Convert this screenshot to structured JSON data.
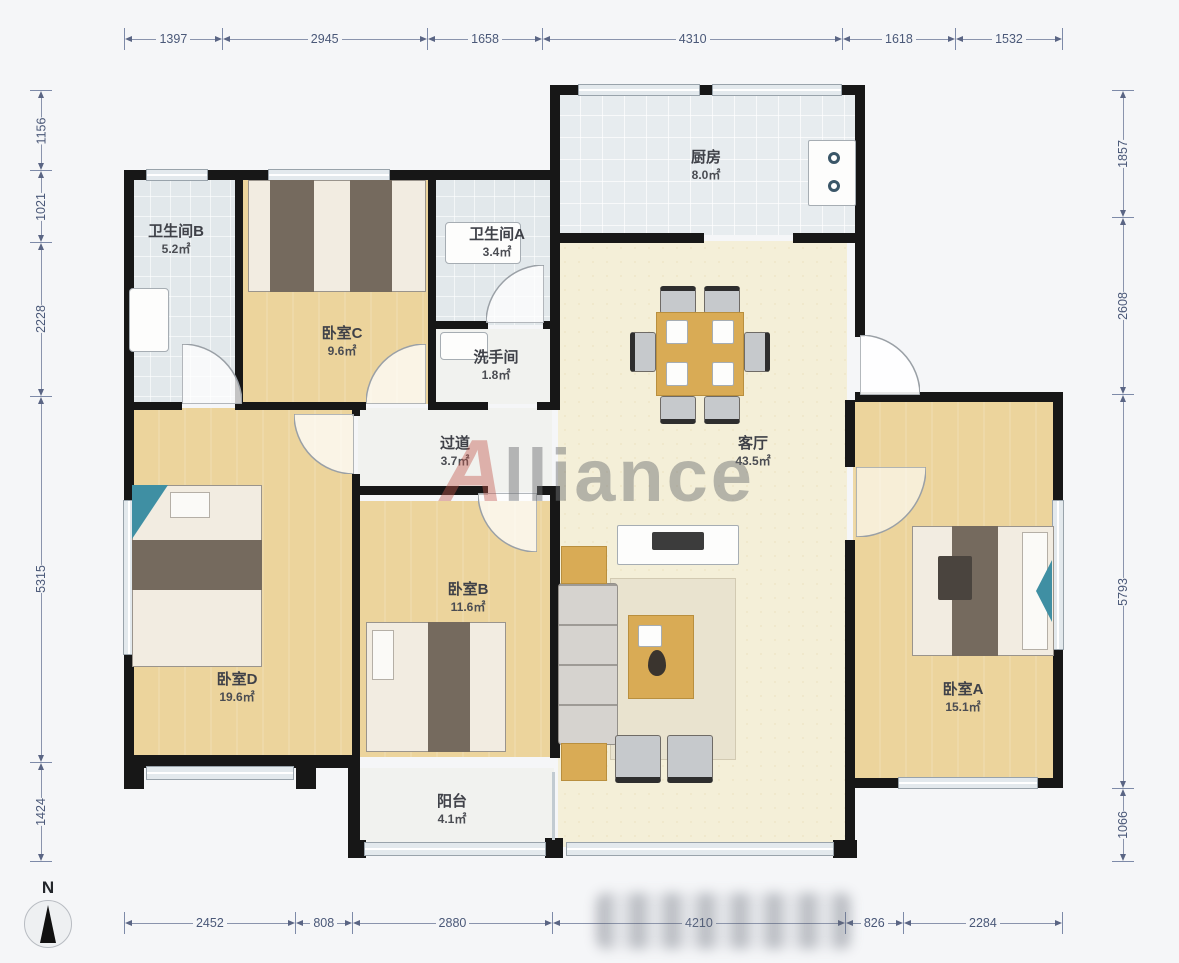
{
  "watermark": {
    "initial": "A",
    "rest": "lliance"
  },
  "north": {
    "label": "N"
  },
  "dimensions": {
    "top": [
      "1397",
      "2945",
      "1658",
      "4310",
      "1618",
      "1532"
    ],
    "bottom": [
      "2452",
      "808",
      "2880",
      "4210",
      "826",
      "2284"
    ],
    "left": [
      "1156",
      "1021",
      "2228",
      "5315",
      "1424"
    ],
    "right": [
      "1857",
      "2608",
      "5793",
      "1066"
    ]
  },
  "rooms": [
    {
      "name": "卫生间B",
      "area": "5.2㎡"
    },
    {
      "name": "卧室C",
      "area": "9.6㎡"
    },
    {
      "name": "卫生间A",
      "area": "3.4㎡"
    },
    {
      "name": "洗手间",
      "area": "1.8㎡"
    },
    {
      "name": "厨房",
      "area": "8.0㎡"
    },
    {
      "name": "过道",
      "area": "3.7㎡"
    },
    {
      "name": "客厅",
      "area": "43.5㎡"
    },
    {
      "name": "卧室B",
      "area": "11.6㎡"
    },
    {
      "name": "卧室D",
      "area": "19.6㎡"
    },
    {
      "name": "卧室A",
      "area": "15.1㎡"
    },
    {
      "name": "阳台",
      "area": "4.1㎡"
    }
  ],
  "colors": {
    "wall": "#171717",
    "wood_floor": "#ecd49c",
    "living_floor": "#f4efd8",
    "tile_floor": "#e7ecef",
    "bath_floor": "#e2e8eb",
    "dimension_text": "#4a5878",
    "watermark_gray": "#77797c",
    "watermark_red": "#c0564a",
    "accent_teal": "#3f8fa3"
  }
}
